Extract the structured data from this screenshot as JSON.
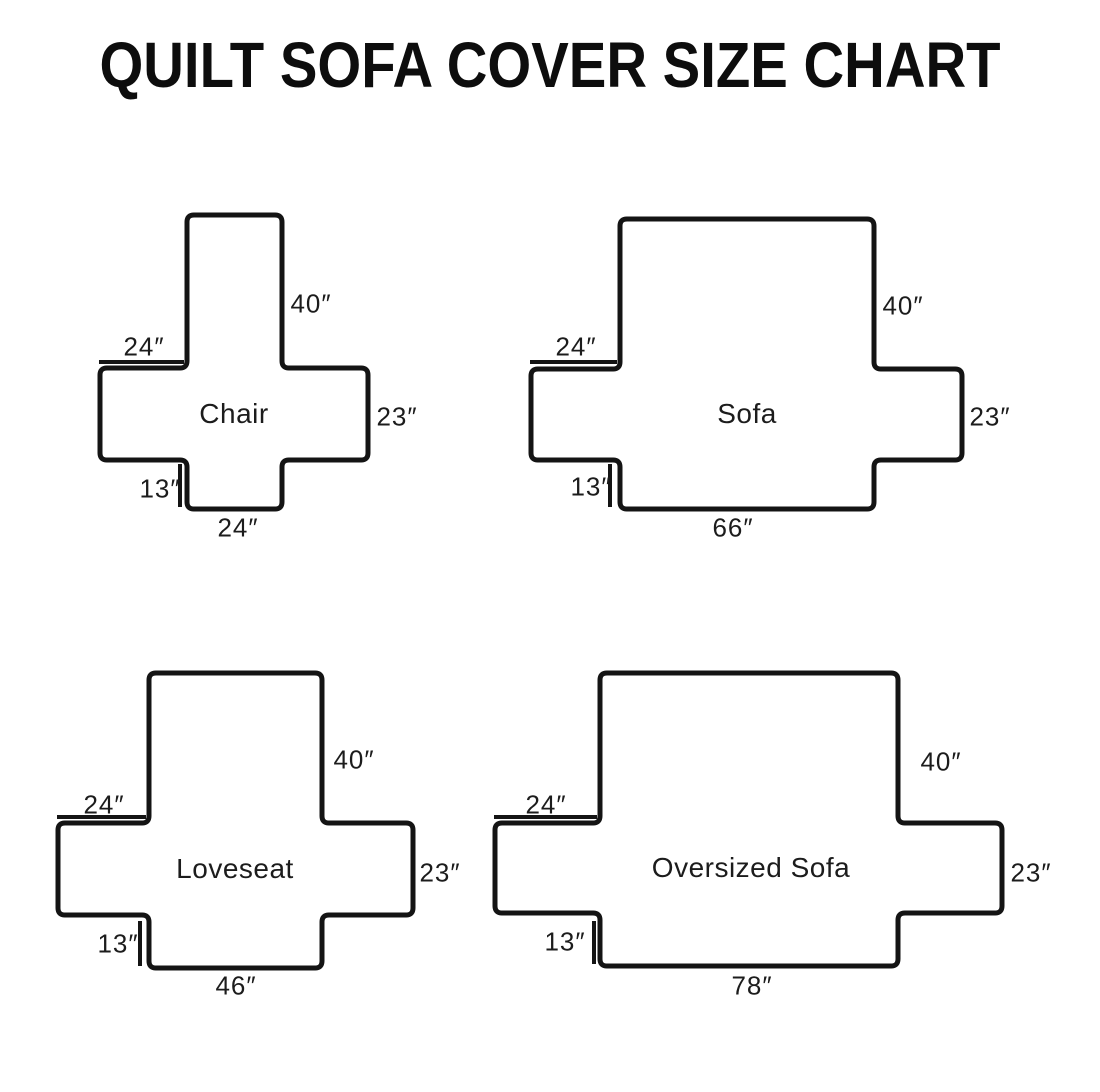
{
  "title": "QUILT SOFA COVER SIZE CHART",
  "figures": [
    {
      "name": "Chair",
      "back_height": "40″",
      "arm_length": "24″",
      "side_height": "23″",
      "front_drop": "13″",
      "bottom_width": "24″"
    },
    {
      "name": "Sofa",
      "back_height": "40″",
      "arm_length": "24″",
      "side_height": "23″",
      "front_drop": "13″",
      "bottom_width": "66″"
    },
    {
      "name": "Loveseat",
      "back_height": "40″",
      "arm_length": "24″",
      "side_height": "23″",
      "front_drop": "13″",
      "bottom_width": "46″"
    },
    {
      "name": "Oversized Sofa",
      "back_height": "40″",
      "arm_length": "24″",
      "side_height": "23″",
      "front_drop": "13″",
      "bottom_width": "78″"
    }
  ],
  "colors": {
    "ink": "#141414",
    "background": "#ffffff"
  }
}
